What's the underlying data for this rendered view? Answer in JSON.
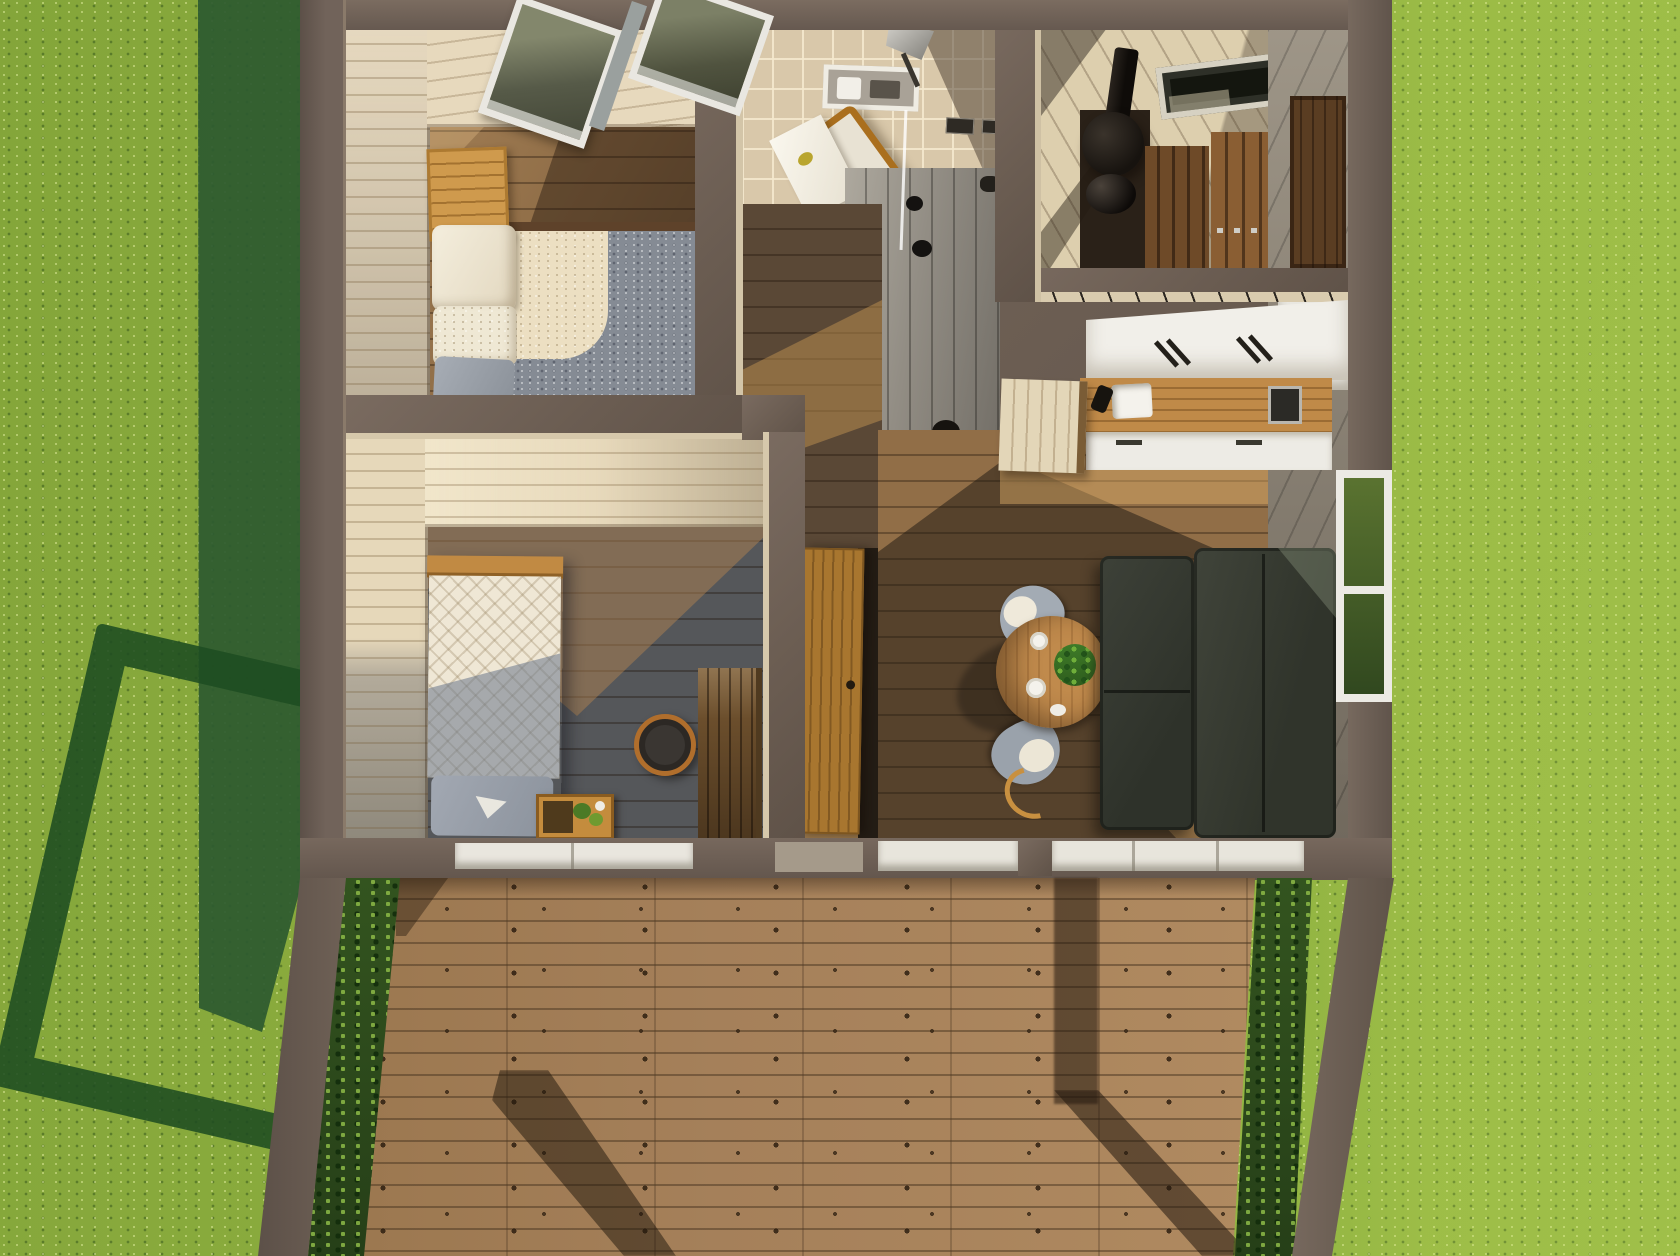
{
  "meta": {
    "domain": "Natural-Image",
    "title": "Aerial top-down 3D render of a modern tiny house floor plan on a sunlit lawn",
    "description": "Bird's-eye architectural render of a small cabin: bedroom with daybed and shag rug under roof windows, tiled bathroom with lounge chair and wall niche, shower room with grey plank floor, sauna with black wood stove and tiered benches, kitchen with white counters and wooden worktop, hallway with open wooden door, second bedroom with patterned bed, living-dining area with charcoal L-sofa and round table, and a wide front wooden deck flanked by hedges. Late afternoon sun casts long shadows across the lawn and deck.",
    "lighting": "warm sun from lower-left; building shadow over left lawn; pergola-frame shadow on grass; post shadows across deck"
  },
  "palette": {
    "grass_sunlit": "#8fb243",
    "grass_shadow": "#2d5a2f",
    "hedge_green": "#2c451d",
    "wall_brown": "#6b5d52",
    "wall_plank_beige": "#ddcfae",
    "floor_walnut": "#5a4836",
    "floor_oak": "#8e6b45",
    "deck_wood": "#a5805a",
    "tile_beige": "#d9c8aa",
    "shower_grey": "#928d84",
    "rug_shadow_grey": "#858b94",
    "rug_sunlit_cream": "#ecdfc2",
    "bedding_cream": "#efe7d5",
    "pillow_grey": "#979ea8",
    "daybed_wood": "#cf9a4d",
    "sauna_bench_wood": "#8a5e33",
    "stove_black": "#17130f",
    "counter_white": "#f1efe9",
    "counter_wood": "#c08a48",
    "sofa_charcoal": "#363a31",
    "table_wood": "#b9854a",
    "chair_shell_grey": "#a3abb4",
    "plant_green": "#3e7b28",
    "window_frame_white": "#eceae4"
  },
  "rooms": [
    {
      "id": "lawn",
      "label": "Surrounding lawn with long building shadow"
    },
    {
      "id": "bedroom-1",
      "label": "Bedroom 1 with daybed, shag rug and two roof windows"
    },
    {
      "id": "bathroom",
      "label": "Bathroom with beige tiles, wall niche, pendant lamp and lounge chair"
    },
    {
      "id": "shower-room",
      "label": "Shower room with grey plank floor and drains"
    },
    {
      "id": "sauna",
      "label": "Sauna with black stove, chimney and tiered wooden benches"
    },
    {
      "id": "kitchen",
      "label": "Kitchen with white counters, wooden worktop, sink and outlets"
    },
    {
      "id": "hallway",
      "label": "Hallway with walnut floor, toilet and open wooden door"
    },
    {
      "id": "bedroom-2",
      "label": "Bedroom 2 with patterned bed, crate nightstand, stool and slatted table"
    },
    {
      "id": "living-room",
      "label": "Living-dining room with charcoal L-sofa, round table and shell chairs"
    },
    {
      "id": "deck",
      "label": "Wide front wooden deck with knotted planks"
    },
    {
      "id": "hedges",
      "label": "Clipped hedges flanking the deck"
    }
  ],
  "furniture": [
    {
      "room": "bedroom-1",
      "label": "honey-wood daybed bench with cream cushions and grey pillow"
    },
    {
      "room": "bedroom-1",
      "label": "two-tone shag rug, cream in sunlight and blue-grey in shade, dark brown border"
    },
    {
      "room": "bedroom-1",
      "label": "two tilted roof windows with white frames"
    },
    {
      "room": "bathroom",
      "label": "wooden lounge chair draped with white towel"
    },
    {
      "room": "bathroom",
      "label": "recessed white wall niche with toiletries"
    },
    {
      "room": "bathroom",
      "label": "grey cone pendant lamp"
    },
    {
      "room": "hallway",
      "label": "white toilet"
    },
    {
      "room": "hallway",
      "label": "open honey-wood door"
    },
    {
      "room": "shower-room",
      "label": "round black floor drains and wall valve"
    },
    {
      "room": "sauna",
      "label": "round black wood stove with chimney and kettle"
    },
    {
      "room": "sauna",
      "label": "two-tier brown slatted benches"
    },
    {
      "room": "sauna",
      "label": "dark roof window with pale frame"
    },
    {
      "room": "kitchen",
      "label": "white countertop run with utensil shadows"
    },
    {
      "room": "kitchen",
      "label": "wooden worktop with white sink and black faucet"
    },
    {
      "room": "kitchen",
      "label": "white cabinet fronts with black handles"
    },
    {
      "room": "kitchen",
      "label": "light wood end partition"
    },
    {
      "room": "bedroom-2",
      "label": "single bed with diamond-patterned cream blanket and grey pillow"
    },
    {
      "room": "bedroom-2",
      "label": "wooden crate nightstand with greenery"
    },
    {
      "room": "bedroom-2",
      "label": "round black stool with wood ring"
    },
    {
      "room": "bedroom-2",
      "label": "dark slatted side table"
    },
    {
      "room": "living-room",
      "label": "charcoal L-shaped sofa"
    },
    {
      "room": "living-room",
      "label": "round wooden dining table with cups and green plant"
    },
    {
      "room": "living-room",
      "label": "two grey shell chairs with white cushions"
    },
    {
      "room": "living-room",
      "label": "white window-bench cushions along south wall"
    },
    {
      "room": "living-room",
      "label": "tall white-framed window showing lawn"
    }
  ]
}
